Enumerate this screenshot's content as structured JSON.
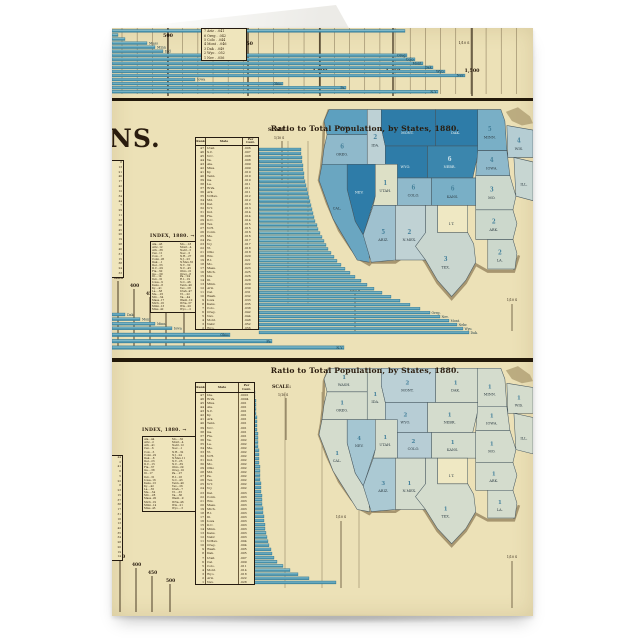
{
  "colors": {
    "paper": "#ece1b7",
    "paper_light": "#efe5bc",
    "ink": "#26190d",
    "rule": "#221809",
    "bar_teal": "#4590ab",
    "bar_highlight": "#8ec3d1",
    "bar_edge": "#2f6f8b",
    "map_dark": "#2e7ca8",
    "coast_tan": "#a08e68",
    "fold_white": "#f7f7f5",
    "grid_line": "#7a6a4c",
    "label_navy": "#173744"
  },
  "chart_data": [
    {
      "type": "bar",
      "name": "top-partial-ranked-bar-chart",
      "scale_ticks": [
        [
          "500",
          56
        ],
        [
          "550",
          136
        ],
        [
          "1,000",
          208
        ],
        [
          "1,250",
          281
        ],
        [
          "1,500",
          360
        ]
      ],
      "tick_note": "1/10 S",
      "box_rows": [
        "7  Ariz . .041",
        "6  Oreg . .042",
        "5  Colo . .044",
        "4  Mont . .046",
        "3  Dak . .049",
        "2  Wyo . .052",
        "1  Nev . .056"
      ],
      "rows": [
        [
          293,
          ""
        ],
        [
          6,
          ""
        ],
        [
          13,
          ""
        ],
        [
          35,
          "Mass"
        ],
        [
          43,
          "Minn"
        ],
        [
          51,
          "Ind"
        ],
        [
          295,
          "Oreg"
        ],
        [
          303,
          "Colo"
        ],
        [
          311,
          "Mont"
        ],
        [
          321,
          "Dak"
        ],
        [
          333,
          "Wyo"
        ],
        [
          353,
          "Nev"
        ],
        [
          83,
          "Iowa"
        ],
        [
          171,
          "Ohio"
        ],
        [
          234,
          "Pa"
        ],
        [
          326,
          "N.Y"
        ]
      ]
    },
    {
      "type": "bar",
      "name": "middle-ranked-bar-chart",
      "title": "Ratio to Total Population, by States, 1880.",
      "fragment": "NS.",
      "scale_label": "SCALE:",
      "tick_note": "1/10 S",
      "index_label": "INDEX, 1880. →",
      "headers": [
        "Rank",
        "State",
        "Per Cent."
      ],
      "rows": [
        [
          47,
          "Utah",
          ".006",
          42
        ],
        [
          46,
          "S.C.",
          ".007",
          42
        ],
        [
          45,
          "N.C.",
          ".008",
          43
        ],
        [
          44,
          "Va.",
          ".008",
          43
        ],
        [
          43,
          "Ala.",
          ".009",
          44
        ],
        [
          42,
          "Miss.",
          ".009",
          44
        ],
        [
          41,
          "Ky.",
          ".010",
          45
        ],
        [
          40,
          "Tenn.",
          ".010",
          45
        ],
        [
          39,
          "Ga.",
          ".010",
          46
        ],
        [
          38,
          "La.",
          ".011",
          47
        ],
        [
          37,
          "W.Va.",
          ".011",
          48
        ],
        [
          36,
          "Ark.",
          ".011",
          49
        ],
        [
          35,
          "N.Mex.",
          ".012",
          50
        ],
        [
          34,
          "Md.",
          ".012",
          51
        ],
        [
          33,
          "Del.",
          ".013",
          52
        ],
        [
          32,
          "N.Y.",
          ".013",
          53
        ],
        [
          31,
          "Ind.",
          ".014",
          54
        ],
        [
          30,
          "Fla.",
          ".014",
          55
        ],
        [
          29,
          "D.C.",
          ".014",
          56
        ],
        [
          28,
          "Tex.",
          ".015",
          58
        ],
        [
          27,
          "N.H.",
          ".015",
          59
        ],
        [
          26,
          "Conn.",
          ".016",
          61
        ],
        [
          25,
          "Me.",
          ".016",
          63
        ],
        [
          24,
          "Pa.",
          ".017",
          65
        ],
        [
          23,
          "N.J.",
          ".017",
          67
        ],
        [
          22,
          "Vt.",
          ".018",
          69
        ],
        [
          21,
          "Ohio",
          ".018",
          72
        ],
        [
          20,
          "Wis.",
          ".020",
          75
        ],
        [
          19,
          "R.I.",
          ".021",
          78
        ],
        [
          18,
          "Mo.",
          ".022",
          82
        ],
        [
          17,
          "Mass.",
          ".023",
          86
        ],
        [
          16,
          "Mich.",
          ".025",
          91
        ],
        [
          15,
          "Ida.",
          ".026",
          96
        ],
        [
          14,
          "Ill.",
          ".028",
          102
        ],
        [
          13,
          "Minn.",
          ".029",
          108
        ],
        [
          12,
          "Ariz.",
          ".030",
          115
        ],
        [
          11,
          "Cal.",
          ".031",
          123
        ],
        [
          10,
          "Wash.",
          ".032",
          132
        ],
        [
          9,
          "Iowa",
          ".033",
          141
        ],
        [
          8,
          "Kans.",
          ".035",
          151
        ],
        [
          7,
          "Colo.",
          ".038",
          161
        ],
        [
          6,
          "Oreg.",
          ".042",
          171
        ],
        [
          5,
          "Nev.",
          ".044",
          181
        ],
        [
          4,
          "Mont.",
          ".048",
          190
        ],
        [
          3,
          "Nebr.",
          ".052",
          198
        ],
        [
          2,
          "Wyo.",
          ".056",
          204
        ],
        [
          1,
          "Dak.",
          ".062",
          210
        ]
      ],
      "end_labels": 6,
      "below_short": [
        [
          "Dak",
          13
        ],
        [
          "Mont",
          28
        ],
        [
          "Minn",
          43
        ],
        [
          "Iowa",
          60
        ]
      ],
      "below_long": [
        [
          "Ohio",
          118
        ],
        [
          "Pa",
          160
        ],
        [
          "N.Y",
          232
        ]
      ],
      "steps": [
        [
          "350",
          2,
          178
        ],
        [
          "400",
          18,
          186
        ],
        [
          "450",
          34,
          194
        ],
        [
          "500",
          50,
          202
        ],
        [
          "550",
          68,
          210
        ]
      ],
      "index_left": [
        "Ala...43",
        "Ariz..12",
        "Ark...36",
        "Cal...11",
        "Colo...7",
        "Conn..26",
        "Dak....1",
        "Del...33",
        "D.C...29",
        "Fla...30",
        "Ga....39",
        "Ill....14",
        "Ind...31",
        "Iowa...9",
        "Kans...8",
        "Ky....41",
        "La....38",
        "Me....25",
        "Md....34",
        "Mass..17",
        "Mich..16",
        "Minn..13",
        "Miss..42"
      ],
      "index_right": [
        "Mo....18",
        "Mont...4",
        "Nebr...3",
        "Nev....5",
        "N.H...27",
        "N.J...23",
        "N.Mex.35",
        "N.Y...32",
        "N.C...45",
        "Ohio..21",
        "Oreg...6",
        "Pa....24",
        "R.I...19",
        "S.C...46",
        "Tenn..40",
        "Tex...28",
        "Utah..47",
        "Vt....22",
        "Va....44",
        "Wash..10",
        "W.Va..37",
        "Wis...20",
        "Wyo....2"
      ],
      "strip": [
        8,
        13,
        21,
        40,
        17,
        42,
        12,
        34,
        44,
        7,
        29,
        11,
        23,
        36,
        45,
        26,
        19,
        28,
        46,
        31,
        15,
        38,
        24,
        33
      ]
    },
    {
      "type": "bar",
      "name": "bottom-ranked-bar-chart",
      "title": "Ratio to Total Population, by States, 1880.",
      "scale_label": "SCALE:",
      "tick_note": "1/10 S",
      "index_label": "INDEX, 1880. →",
      "headers": [
        "Rank",
        "State",
        "Per Cent."
      ],
      "rows": [
        [
          47,
          "Ida.",
          ".0001",
          1
        ],
        [
          46,
          "W.Va.",
          ".0004",
          1
        ],
        [
          45,
          "Miss.",
          ".001",
          2
        ],
        [
          44,
          "Ala.",
          ".001",
          2
        ],
        [
          43,
          "S.C.",
          ".001",
          2
        ],
        [
          42,
          "Ky.",
          ".001",
          2
        ],
        [
          41,
          "Ark.",
          ".001",
          3
        ],
        [
          40,
          "Tenn.",
          ".001",
          3
        ],
        [
          39,
          "N.C.",
          ".001",
          3
        ],
        [
          38,
          "Ga.",
          ".001",
          3
        ],
        [
          37,
          "Fla.",
          ".001",
          4
        ],
        [
          36,
          "Va.",
          ".002",
          4
        ],
        [
          35,
          "La.",
          ".002",
          4
        ],
        [
          34,
          "Me.",
          ".002",
          4
        ],
        [
          33,
          "Vt.",
          ".002",
          5
        ],
        [
          32,
          "N.H.",
          ".002",
          5
        ],
        [
          31,
          "Ind.",
          ".002",
          5
        ],
        [
          30,
          "Mo.",
          ".002",
          5
        ],
        [
          29,
          "Ohio",
          ".002",
          6
        ],
        [
          28,
          "Md.",
          ".002",
          6
        ],
        [
          27,
          "Pa.",
          ".002",
          6
        ],
        [
          26,
          "Tex.",
          ".002",
          6
        ],
        [
          25,
          "N.Y.",
          ".002",
          7
        ],
        [
          24,
          "N.J.",
          ".002",
          7
        ],
        [
          23,
          "Del.",
          ".003",
          7
        ],
        [
          22,
          "Conn.",
          ".003",
          8
        ],
        [
          21,
          "Wis.",
          ".003",
          8
        ],
        [
          20,
          "Mass.",
          ".003",
          8
        ],
        [
          19,
          "Mich.",
          ".003",
          9
        ],
        [
          18,
          "R.I.",
          ".003",
          9
        ],
        [
          17,
          "Ill.",
          ".003",
          10
        ],
        [
          16,
          "Iowa",
          ".003",
          10
        ],
        [
          15,
          "D.C.",
          ".003",
          11
        ],
        [
          14,
          "Minn.",
          ".003",
          11
        ],
        [
          13,
          "Kans.",
          ".003",
          12
        ],
        [
          12,
          "Nebr.",
          ".003",
          13
        ],
        [
          11,
          "N.Mex.",
          ".004",
          14
        ],
        [
          10,
          "Oreg.",
          ".004",
          15
        ],
        [
          9,
          "Wash.",
          ".005",
          17
        ],
        [
          8,
          "Dak.",
          ".005",
          18
        ],
        [
          7,
          "Utah",
          ".007",
          20
        ],
        [
          6,
          "Cal.",
          ".009",
          23
        ],
        [
          5,
          "Colo.",
          ".011",
          29
        ],
        [
          4,
          "Mont.",
          ".014",
          36
        ],
        [
          3,
          "Wyo.",
          ".018",
          44
        ],
        [
          2,
          "Ariz.",
          ".022",
          55
        ],
        [
          1,
          "Nev.",
          ".028",
          82
        ]
      ],
      "end_labels": 0,
      "below_short": [],
      "below_long": [],
      "steps": [
        [
          "350",
          4,
          196
        ],
        [
          "400",
          20,
          204
        ],
        [
          "450",
          36,
          212
        ],
        [
          "500",
          54,
          220
        ]
      ],
      "index_left": [
        "Ala...44",
        "Ariz...2",
        "Ark...41",
        "Cal....6",
        "Colo...5",
        "Conn..22",
        "Dak....8",
        "Del...23",
        "D.C...15",
        "Fla...37",
        "Ga....38",
        "Ill...17",
        "Ind...31",
        "Iowa..16",
        "Kans..13",
        "Ky....42",
        "La....35",
        "Me....34",
        "Md....28",
        "Mass..20",
        "Mich..19",
        "Minn..14",
        "Miss..45"
      ],
      "index_right": [
        "Mo....30",
        "Mont...4",
        "Nebr..12",
        "Nev....1",
        "N.H...32",
        "N.J...24",
        "N.Mex.11",
        "N.Y...25",
        "N.C...39",
        "Ohio..29",
        "Oreg..10",
        "Pa....27",
        "R.I...18",
        "S.C...43",
        "Tenn..40",
        "Tex...26",
        "Utah...7",
        "Vt....33",
        "Va....36",
        "Wash...9",
        "W.Va..46",
        "Wis...21",
        "Wyo....3"
      ],
      "strip": [
        44,
        2,
        41,
        6,
        5,
        22,
        8,
        23,
        15,
        37,
        38,
        17,
        31,
        16,
        13,
        42,
        35,
        34,
        28,
        20,
        19,
        14
      ]
    },
    {
      "type": "heatmap",
      "name": "middle-choropleth-map",
      "title": "Ratio to Total Population, by States, 1880.",
      "states": [
        [
          "WASH",
          "#5da0bf",
          ""
        ],
        [
          "OREG",
          "#8fb9cb",
          "6"
        ],
        [
          "IDA",
          "#bdd1d5",
          "2"
        ],
        [
          "MONT",
          "#2e7ca8",
          ""
        ],
        [
          "DAK",
          "#2e7ca8",
          ""
        ],
        [
          "MINN",
          "#79afc6",
          "5"
        ],
        [
          "WIS",
          "#b5cdd3",
          "4"
        ],
        [
          "WYO",
          "#2e7ca8",
          ""
        ],
        [
          "NEBR",
          "#3b86ad",
          "6"
        ],
        [
          "IOWA",
          "#8fb9cb",
          "4"
        ],
        [
          "ILL",
          "#c7d6d2",
          ""
        ],
        [
          "NEV",
          "#2e7ca8",
          ""
        ],
        [
          "UTAH",
          "#dde0c6",
          "1"
        ],
        [
          "COLO",
          "#8fb9cb",
          "6"
        ],
        [
          "KANS",
          "#79afc6",
          "6"
        ],
        [
          "MO",
          "#ccd8cc",
          "3"
        ],
        [
          "CAL",
          "#6aa6c1",
          ""
        ],
        [
          "ARIZ",
          "#9fc1cf",
          "5"
        ],
        [
          "NMEX",
          "#c0d2d4",
          "2"
        ],
        [
          "IT",
          "#efe8c3",
          ""
        ],
        [
          "ARK",
          "#ccd8cc",
          "2"
        ],
        [
          "LA",
          "#ccd8cc",
          "2"
        ],
        [
          "TEX",
          "#c9d6cf",
          "3"
        ]
      ]
    },
    {
      "type": "heatmap",
      "name": "bottom-choropleth-map",
      "title": "Ratio to Total Population, by States, 1880.",
      "states": [
        [
          "WASH",
          "#d4dccd",
          "1"
        ],
        [
          "OREG",
          "#d4dccd",
          "1"
        ],
        [
          "IDA",
          "#d4dccd",
          "1"
        ],
        [
          "MONT",
          "#bbd0d6",
          "2"
        ],
        [
          "DAK",
          "#d4dccd",
          "1"
        ],
        [
          "MINN",
          "#d4dccd",
          "1"
        ],
        [
          "WIS",
          "#d4dccd",
          "1"
        ],
        [
          "WYO",
          "#b7cdd5",
          "2"
        ],
        [
          "NEBR",
          "#d4dccd",
          "1"
        ],
        [
          "IOWA",
          "#d4dccd",
          "1"
        ],
        [
          "ILL",
          "#d4dccd",
          ""
        ],
        [
          "NEV",
          "#a5c6d2",
          "4"
        ],
        [
          "UTAH",
          "#d4dccd",
          "1"
        ],
        [
          "COLO",
          "#b7cdd5",
          "2"
        ],
        [
          "KANS",
          "#d4dccd",
          "1"
        ],
        [
          "MO",
          "#d4dccd",
          "1"
        ],
        [
          "CAL",
          "#d4dccd",
          "1"
        ],
        [
          "ARIZ",
          "#abc9d3",
          "3"
        ],
        [
          "NMEX",
          "#d4dccd",
          "1"
        ],
        [
          "IT",
          "#efe8c3",
          ""
        ],
        [
          "ARK",
          "#d4dccd",
          "1"
        ],
        [
          "LA",
          "#d4dccd",
          "1"
        ],
        [
          "TEX",
          "#d4dccd",
          "1"
        ]
      ]
    }
  ]
}
